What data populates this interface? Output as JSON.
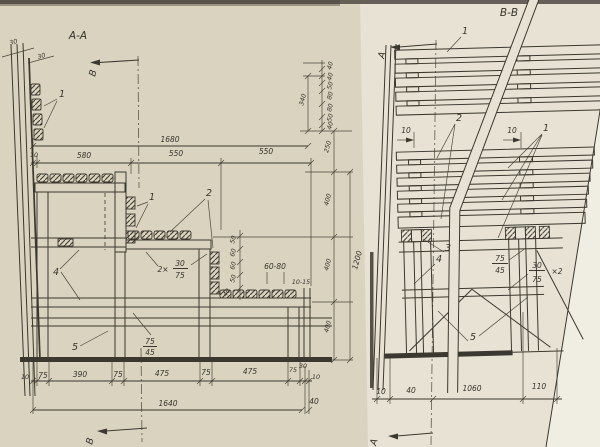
{
  "palette": {
    "paper_left": "#dad3bf",
    "paper_right": "#e7e2d3",
    "paper_edge": "#f0ede3",
    "ink": "#3b382f",
    "scan_edge": "#4f4a41"
  },
  "lv": {
    "title": "А-А",
    "mkr_top": "В",
    "mkr_bottom": "В",
    "w30a": "30",
    "w30b": "30",
    "lbl1a": "1",
    "lbl1b": "1",
    "lbl2": "2",
    "lbl4": "4",
    "lbl5": "5",
    "d1680": "1680",
    "d10": "10",
    "d580": "580",
    "d550a": "550",
    "d550b": "550",
    "b40top": "40",
    "b40a": "40",
    "b50a": "50",
    "b80a": "80",
    "b80b": "80",
    "b50b": "50",
    "b40b": "40",
    "b340": "340",
    "h250": "250",
    "h400a": "400",
    "h400b": "400",
    "h400c": "400",
    "h1200": "1200",
    "g50a": "50",
    "g60a": "60",
    "g60b": "60",
    "g50b": "50",
    "g40": "40",
    "n6080": "60-80",
    "n1015": "10-15",
    "f2x": "2×",
    "f2n": "30",
    "f2d": "75",
    "f5n": "75",
    "f5d": "45",
    "c10a": "10",
    "c75a": "75",
    "c390": "390",
    "c75b": "75",
    "c475a": "475",
    "c75c": "75",
    "c475b": "475",
    "c75d": "75",
    "c30": "30",
    "c10b": "10",
    "t1640": "1640",
    "t40": "40"
  },
  "rv": {
    "title": "В-В",
    "mkr_top": "А",
    "mkr_bottom": "А",
    "lbl1a": "1",
    "lbl2": "2",
    "lbl1b": "1",
    "lbl3": "3",
    "lbl4": "4",
    "lbl5": "5",
    "g10a": "10",
    "g10b": "10",
    "f1n": "75",
    "f1d": "45",
    "f2n": "30",
    "f2d": "75",
    "f2x": "×2",
    "c10": "10",
    "c40": "40",
    "c1060": "1060",
    "c110": "110"
  }
}
